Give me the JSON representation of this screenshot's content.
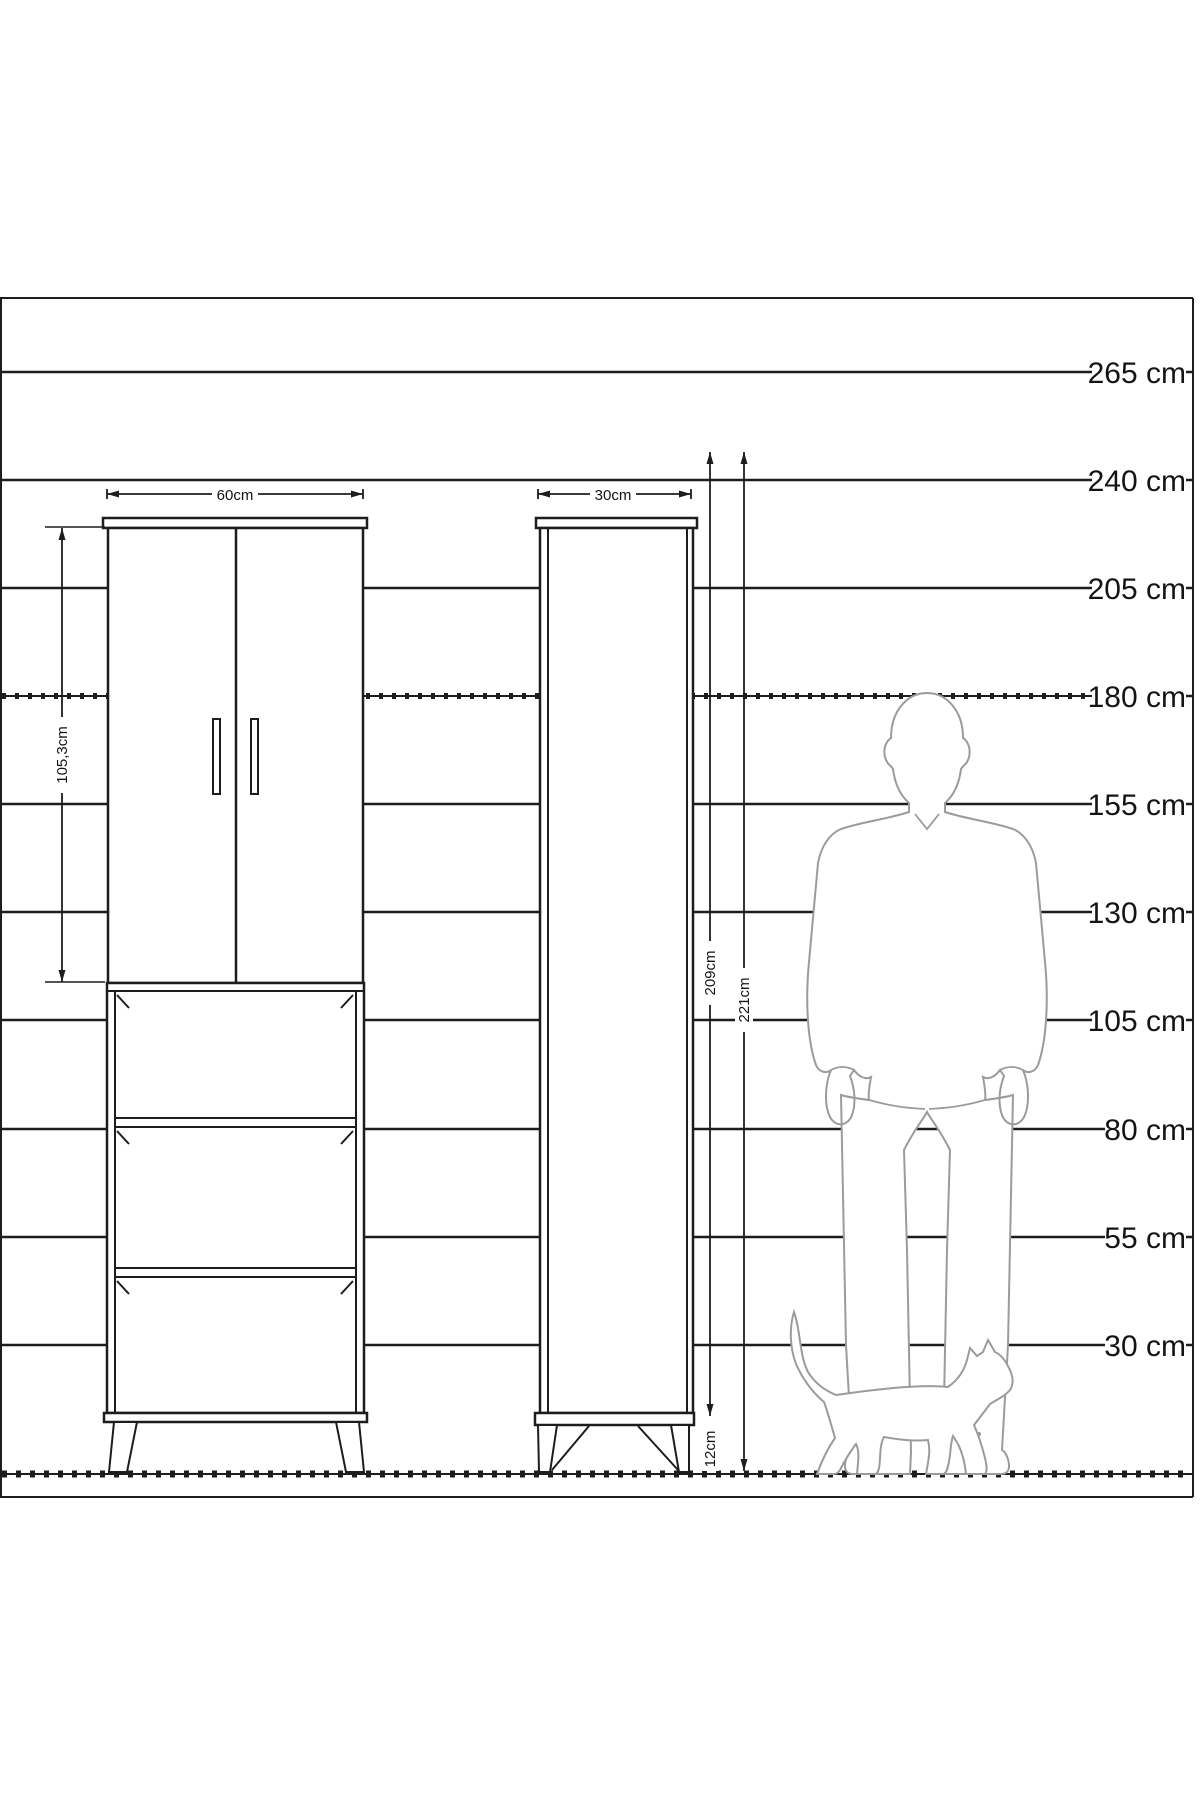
{
  "diagram": {
    "type": "furniture-dimension-diagram",
    "scale_labels": [
      "265 cm",
      "240 cm",
      "205 cm",
      "180 cm",
      "155 cm",
      "130 cm",
      "105 cm",
      "80 cm",
      "55 cm",
      "30 cm"
    ],
    "dimensions": {
      "left_cabinet_width": "60cm",
      "right_cabinet_width": "30cm",
      "door_height": "105,3cm",
      "body_height": "209cm",
      "total_height": "221cm",
      "leg_height": "12cm"
    },
    "colors": {
      "line": "#1d1d1d",
      "silhouette": "#9b9b9b",
      "background": "#ffffff"
    }
  }
}
